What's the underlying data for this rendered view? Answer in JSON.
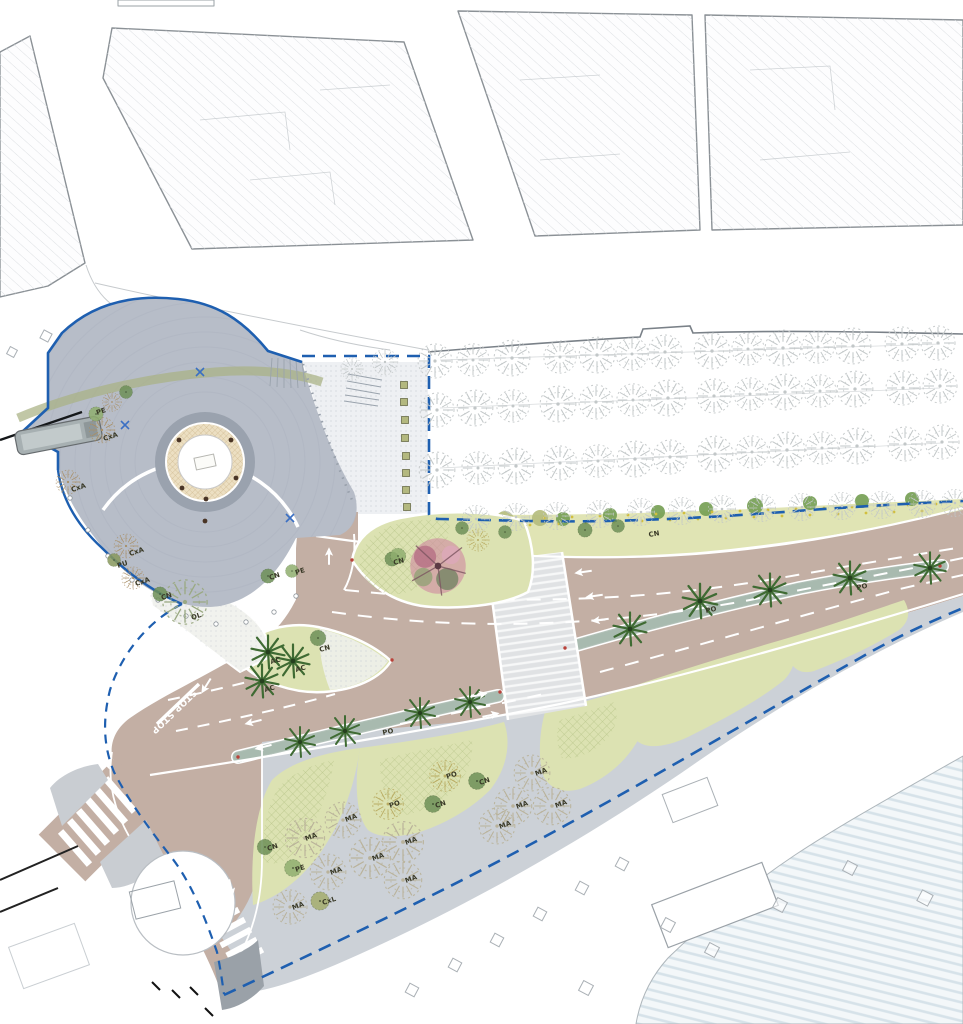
{
  "plan": {
    "stop_marking": "STOP STOP",
    "colors": {
      "boundary": "#1e5fb0",
      "road": "#c3afa4",
      "roadLine": "#ffffff",
      "plaza": "#b7bdc8",
      "plazaRing": "#9aa2ae",
      "fountainHatch": "#c8b085",
      "green": "#dce2b2",
      "strip": "#e0e4b4",
      "greenBush": "#76a055",
      "oliveBush": "#b5bd7e",
      "median": "#b2c1b8",
      "prom": "#ccd1d7",
      "promDark": "#9aa1a8",
      "esp": "#eef0f3",
      "blockline": "#8b9196",
      "sketchTree": "#c2c7c8",
      "maTree": "#b9b29a",
      "palm": "#3f6b33",
      "pinkTree": "#cf8fa2",
      "speckle": "#d2bf3e",
      "black": "#1a1a1a"
    },
    "species_labels": [
      {
        "t": "PE",
        "x": 97,
        "y": 415,
        "r": -18
      },
      {
        "t": "CxA",
        "x": 104,
        "y": 441,
        "r": -18
      },
      {
        "t": "CxA",
        "x": 72,
        "y": 492,
        "r": -18
      },
      {
        "t": "CxA",
        "x": 130,
        "y": 556,
        "r": -18
      },
      {
        "t": "PU",
        "x": 118,
        "y": 568,
        "r": -18
      },
      {
        "t": "CxA",
        "x": 136,
        "y": 586,
        "r": -18
      },
      {
        "t": "CN",
        "x": 162,
        "y": 600,
        "r": -18
      },
      {
        "t": "OL",
        "x": 192,
        "y": 620,
        "r": -18
      },
      {
        "t": "CN",
        "x": 270,
        "y": 580,
        "r": -18
      },
      {
        "t": "PE",
        "x": 296,
        "y": 575,
        "r": -18
      },
      {
        "t": "CN",
        "x": 394,
        "y": 565,
        "r": -15
      },
      {
        "t": "CN",
        "x": 320,
        "y": 652,
        "r": -15
      },
      {
        "t": "AC",
        "x": 271,
        "y": 664,
        "r": -15
      },
      {
        "t": "AC",
        "x": 296,
        "y": 672,
        "r": -15
      },
      {
        "t": "AC",
        "x": 265,
        "y": 692,
        "r": -15
      },
      {
        "t": "PO",
        "x": 383,
        "y": 735,
        "r": -12
      },
      {
        "t": "PO",
        "x": 706,
        "y": 613,
        "r": -12
      },
      {
        "t": "PO",
        "x": 857,
        "y": 590,
        "r": -12
      },
      {
        "t": "CN",
        "x": 649,
        "y": 537,
        "r": -10
      },
      {
        "t": "PO",
        "x": 447,
        "y": 779,
        "r": -18
      },
      {
        "t": "PO",
        "x": 390,
        "y": 808,
        "r": -18
      },
      {
        "t": "CN",
        "x": 436,
        "y": 808,
        "r": -18
      },
      {
        "t": "CN",
        "x": 480,
        "y": 785,
        "r": -18
      },
      {
        "t": "CN",
        "x": 268,
        "y": 851,
        "r": -18
      },
      {
        "t": "PE",
        "x": 296,
        "y": 872,
        "r": -18
      },
      {
        "t": "CxL",
        "x": 323,
        "y": 905,
        "r": -18
      },
      {
        "t": "MA",
        "x": 306,
        "y": 841,
        "r": -20
      },
      {
        "t": "MA",
        "x": 346,
        "y": 822,
        "r": -20
      },
      {
        "t": "MA",
        "x": 373,
        "y": 861,
        "r": -20
      },
      {
        "t": "MA",
        "x": 331,
        "y": 875,
        "r": -20
      },
      {
        "t": "MA",
        "x": 406,
        "y": 845,
        "r": -20
      },
      {
        "t": "MA",
        "x": 406,
        "y": 883,
        "r": -20
      },
      {
        "t": "MA",
        "x": 293,
        "y": 910,
        "r": -20
      },
      {
        "t": "MA",
        "x": 536,
        "y": 776,
        "r": -20
      },
      {
        "t": "MA",
        "x": 517,
        "y": 809,
        "r": -20
      },
      {
        "t": "MA",
        "x": 556,
        "y": 808,
        "r": -20
      },
      {
        "t": "MA",
        "x": 500,
        "y": 829,
        "r": -20
      }
    ],
    "trees": [
      [
        "sketch",
        435,
        361,
        40
      ],
      [
        "sketch",
        473,
        360,
        38
      ],
      [
        "sketch",
        512,
        358,
        42
      ],
      [
        "sketch",
        560,
        357,
        38
      ],
      [
        "sketch",
        597,
        355,
        42
      ],
      [
        "sketch",
        632,
        354,
        38
      ],
      [
        "sketch",
        665,
        352,
        40
      ],
      [
        "sketch",
        712,
        351,
        42
      ],
      [
        "sketch",
        748,
        349,
        38
      ],
      [
        "sketch",
        783,
        348,
        42
      ],
      [
        "sketch",
        818,
        347,
        38
      ],
      [
        "sketch",
        853,
        346,
        42
      ],
      [
        "sketch",
        902,
        344,
        40
      ],
      [
        "sketch",
        938,
        343,
        40
      ],
      [
        "sketch",
        437,
        410,
        40
      ],
      [
        "sketch",
        475,
        408,
        42
      ],
      [
        "sketch",
        513,
        406,
        38
      ],
      [
        "sketch",
        558,
        404,
        42
      ],
      [
        "sketch",
        596,
        402,
        40
      ],
      [
        "sketch",
        633,
        400,
        38
      ],
      [
        "sketch",
        668,
        398,
        42
      ],
      [
        "sketch",
        714,
        396,
        40
      ],
      [
        "sketch",
        750,
        394,
        38
      ],
      [
        "sketch",
        785,
        392,
        42
      ],
      [
        "sketch",
        820,
        391,
        38
      ],
      [
        "sketch",
        855,
        389,
        42
      ],
      [
        "sketch",
        903,
        388,
        40
      ],
      [
        "sketch",
        940,
        386,
        40
      ],
      [
        "sketch",
        437,
        470,
        42
      ],
      [
        "sketch",
        478,
        468,
        38
      ],
      [
        "sketch",
        516,
        466,
        42
      ],
      [
        "sketch",
        560,
        463,
        40
      ],
      [
        "sketch",
        598,
        461,
        38
      ],
      [
        "sketch",
        635,
        459,
        42
      ],
      [
        "sketch",
        670,
        457,
        40
      ],
      [
        "sketch",
        715,
        454,
        42
      ],
      [
        "sketch",
        752,
        452,
        38
      ],
      [
        "sketch",
        787,
        450,
        42
      ],
      [
        "sketch",
        822,
        448,
        38
      ],
      [
        "sketch",
        857,
        446,
        42
      ],
      [
        "sketch",
        905,
        444,
        40
      ],
      [
        "sketch",
        942,
        442,
        40
      ],
      [
        "sketch",
        476,
        519,
        32
      ],
      [
        "sketch",
        516,
        517,
        32
      ],
      [
        "sketch",
        557,
        516,
        32
      ],
      [
        "sketch",
        600,
        514,
        32
      ],
      [
        "sketch",
        641,
        512,
        32
      ],
      [
        "sketch",
        682,
        511,
        32
      ],
      [
        "sketch",
        722,
        509,
        32
      ],
      [
        "sketch",
        762,
        508,
        32
      ],
      [
        "sketch",
        802,
        507,
        32
      ],
      [
        "sketch",
        842,
        506,
        32
      ],
      [
        "sketch",
        882,
        505,
        32
      ],
      [
        "sketch",
        922,
        504,
        32
      ],
      [
        "sketch",
        955,
        503,
        32
      ],
      [
        "sketch",
        385,
        362,
        30
      ],
      [
        "sketch",
        352,
        369,
        26
      ],
      [
        "ma",
        305,
        838,
        46
      ],
      [
        "ma",
        343,
        820,
        42
      ],
      [
        "ma",
        370,
        858,
        48
      ],
      [
        "ma",
        328,
        872,
        42
      ],
      [
        "ma",
        403,
        842,
        48
      ],
      [
        "ma",
        403,
        880,
        44
      ],
      [
        "ma",
        290,
        907,
        40
      ],
      [
        "ma",
        497,
        826,
        42
      ],
      [
        "ma",
        513,
        806,
        44
      ],
      [
        "ma",
        552,
        806,
        44
      ],
      [
        "ma",
        532,
        773,
        42
      ],
      [
        "cxa",
        102,
        430,
        30
      ],
      [
        "cxa",
        68,
        482,
        28
      ],
      [
        "cxa",
        126,
        546,
        28
      ],
      [
        "cxa",
        133,
        578,
        26
      ],
      [
        "cxa",
        112,
        402,
        22
      ],
      [
        "ol",
        185,
        602,
        52
      ],
      [
        "po",
        445,
        776,
        36
      ],
      [
        "po",
        388,
        804,
        36
      ],
      [
        "po",
        478,
        540,
        26
      ],
      [
        "cn",
        477,
        781,
        26
      ],
      [
        "cn",
        433,
        804,
        26
      ],
      [
        "cn",
        265,
        847,
        24
      ],
      [
        "cn",
        160,
        594,
        22
      ],
      [
        "cn",
        268,
        576,
        22
      ],
      [
        "cn",
        318,
        638,
        24
      ],
      [
        "cn",
        392,
        559,
        22
      ],
      [
        "cn",
        462,
        528,
        20
      ],
      [
        "cn",
        505,
        532,
        20
      ],
      [
        "cn",
        585,
        530,
        22
      ],
      [
        "cn",
        618,
        526,
        20
      ],
      [
        "cn",
        126,
        392,
        20
      ],
      [
        "pe",
        293,
        868,
        26
      ],
      [
        "pe",
        292,
        571,
        20
      ],
      [
        "pe",
        96,
        414,
        22
      ],
      [
        "pe",
        398,
        556,
        24
      ],
      [
        "cxl",
        320,
        901,
        28
      ],
      [
        "pu",
        114,
        560,
        20
      ],
      [
        "pink",
        438,
        566,
        74
      ],
      [
        "palm",
        268,
        652,
        44
      ],
      [
        "palm",
        293,
        661,
        44
      ],
      [
        "palm",
        262,
        681,
        44
      ],
      [
        "palm",
        300,
        742,
        40
      ],
      [
        "palm",
        345,
        731,
        40
      ],
      [
        "palm",
        420,
        713,
        40
      ],
      [
        "palm",
        470,
        702,
        40
      ],
      [
        "palm",
        630,
        629,
        44
      ],
      [
        "palm",
        700,
        601,
        46
      ],
      [
        "palm",
        770,
        590,
        44
      ],
      [
        "palm",
        850,
        578,
        44
      ],
      [
        "palm",
        930,
        568,
        42
      ]
    ],
    "arrows": [
      [
        583,
        572,
        262
      ],
      [
        594,
        596,
        262
      ],
      [
        600,
        620,
        262
      ],
      [
        253,
        722,
        256
      ],
      [
        263,
        747,
        256
      ],
      [
        479,
        695,
        78
      ],
      [
        491,
        715,
        78
      ],
      [
        184,
        671,
        212
      ],
      [
        206,
        686,
        212
      ],
      [
        329,
        556,
        0
      ],
      [
        231,
        888,
        168
      ]
    ],
    "bushes_green": [
      [
        563,
        519,
        7
      ],
      [
        610,
        515,
        7
      ],
      [
        658,
        512,
        7
      ],
      [
        706,
        509,
        7
      ],
      [
        755,
        506,
        8
      ],
      [
        810,
        503,
        7
      ],
      [
        862,
        501,
        7
      ],
      [
        912,
        499,
        7
      ]
    ],
    "bushes_olive": [
      [
        445,
        525,
        8
      ],
      [
        470,
        522,
        9
      ],
      [
        505,
        520,
        9
      ],
      [
        540,
        518,
        8
      ]
    ],
    "speckles": [
      [
        447,
        527
      ],
      [
        460,
        522
      ],
      [
        474,
        528
      ],
      [
        488,
        520
      ],
      [
        502,
        526
      ],
      [
        516,
        519
      ],
      [
        530,
        525
      ],
      [
        544,
        518
      ],
      [
        558,
        524
      ],
      [
        572,
        517
      ],
      [
        586,
        523
      ],
      [
        600,
        516
      ],
      [
        614,
        522
      ],
      [
        628,
        515
      ],
      [
        642,
        521
      ],
      [
        656,
        514
      ],
      [
        670,
        520
      ],
      [
        684,
        513
      ],
      [
        698,
        519
      ],
      [
        712,
        512
      ],
      [
        726,
        518
      ],
      [
        740,
        511
      ],
      [
        754,
        517
      ],
      [
        768,
        510
      ],
      [
        782,
        516
      ],
      [
        796,
        509
      ],
      [
        810,
        515
      ],
      [
        824,
        508
      ],
      [
        838,
        514
      ],
      [
        852,
        507
      ],
      [
        866,
        513
      ],
      [
        880,
        506
      ],
      [
        894,
        512
      ],
      [
        908,
        505
      ],
      [
        922,
        511
      ],
      [
        936,
        504
      ]
    ],
    "planters": [
      [
        404,
        385
      ],
      [
        404,
        402
      ],
      [
        405,
        420
      ],
      [
        405,
        438
      ],
      [
        406,
        456
      ],
      [
        406,
        473
      ],
      [
        406,
        490
      ],
      [
        407,
        507
      ]
    ],
    "ghost_squares": [
      [
        412,
        990,
        10
      ],
      [
        455,
        965,
        10
      ],
      [
        497,
        940,
        10
      ],
      [
        540,
        914,
        10
      ],
      [
        582,
        888,
        10
      ],
      [
        622,
        864,
        10
      ],
      [
        668,
        925,
        11
      ],
      [
        712,
        950,
        11
      ],
      [
        780,
        905,
        11
      ],
      [
        850,
        868,
        11
      ],
      [
        925,
        898,
        12
      ],
      [
        586,
        988,
        11
      ],
      [
        46,
        336,
        9
      ],
      [
        12,
        352,
        8
      ]
    ],
    "lights": [
      [
        70,
        498
      ],
      [
        88,
        530
      ],
      [
        108,
        556
      ],
      [
        132,
        580
      ],
      [
        158,
        600
      ],
      [
        186,
        616
      ],
      [
        216,
        624
      ],
      [
        246,
        622
      ],
      [
        274,
        612
      ],
      [
        296,
        596
      ]
    ],
    "xmarks": [
      [
        200,
        372
      ],
      [
        125,
        425
      ],
      [
        290,
        518
      ]
    ],
    "reddots": [
      [
        352,
        560
      ],
      [
        500,
        692
      ],
      [
        565,
        648
      ],
      [
        940,
        566
      ],
      [
        238,
        757
      ],
      [
        392,
        660
      ]
    ]
  }
}
